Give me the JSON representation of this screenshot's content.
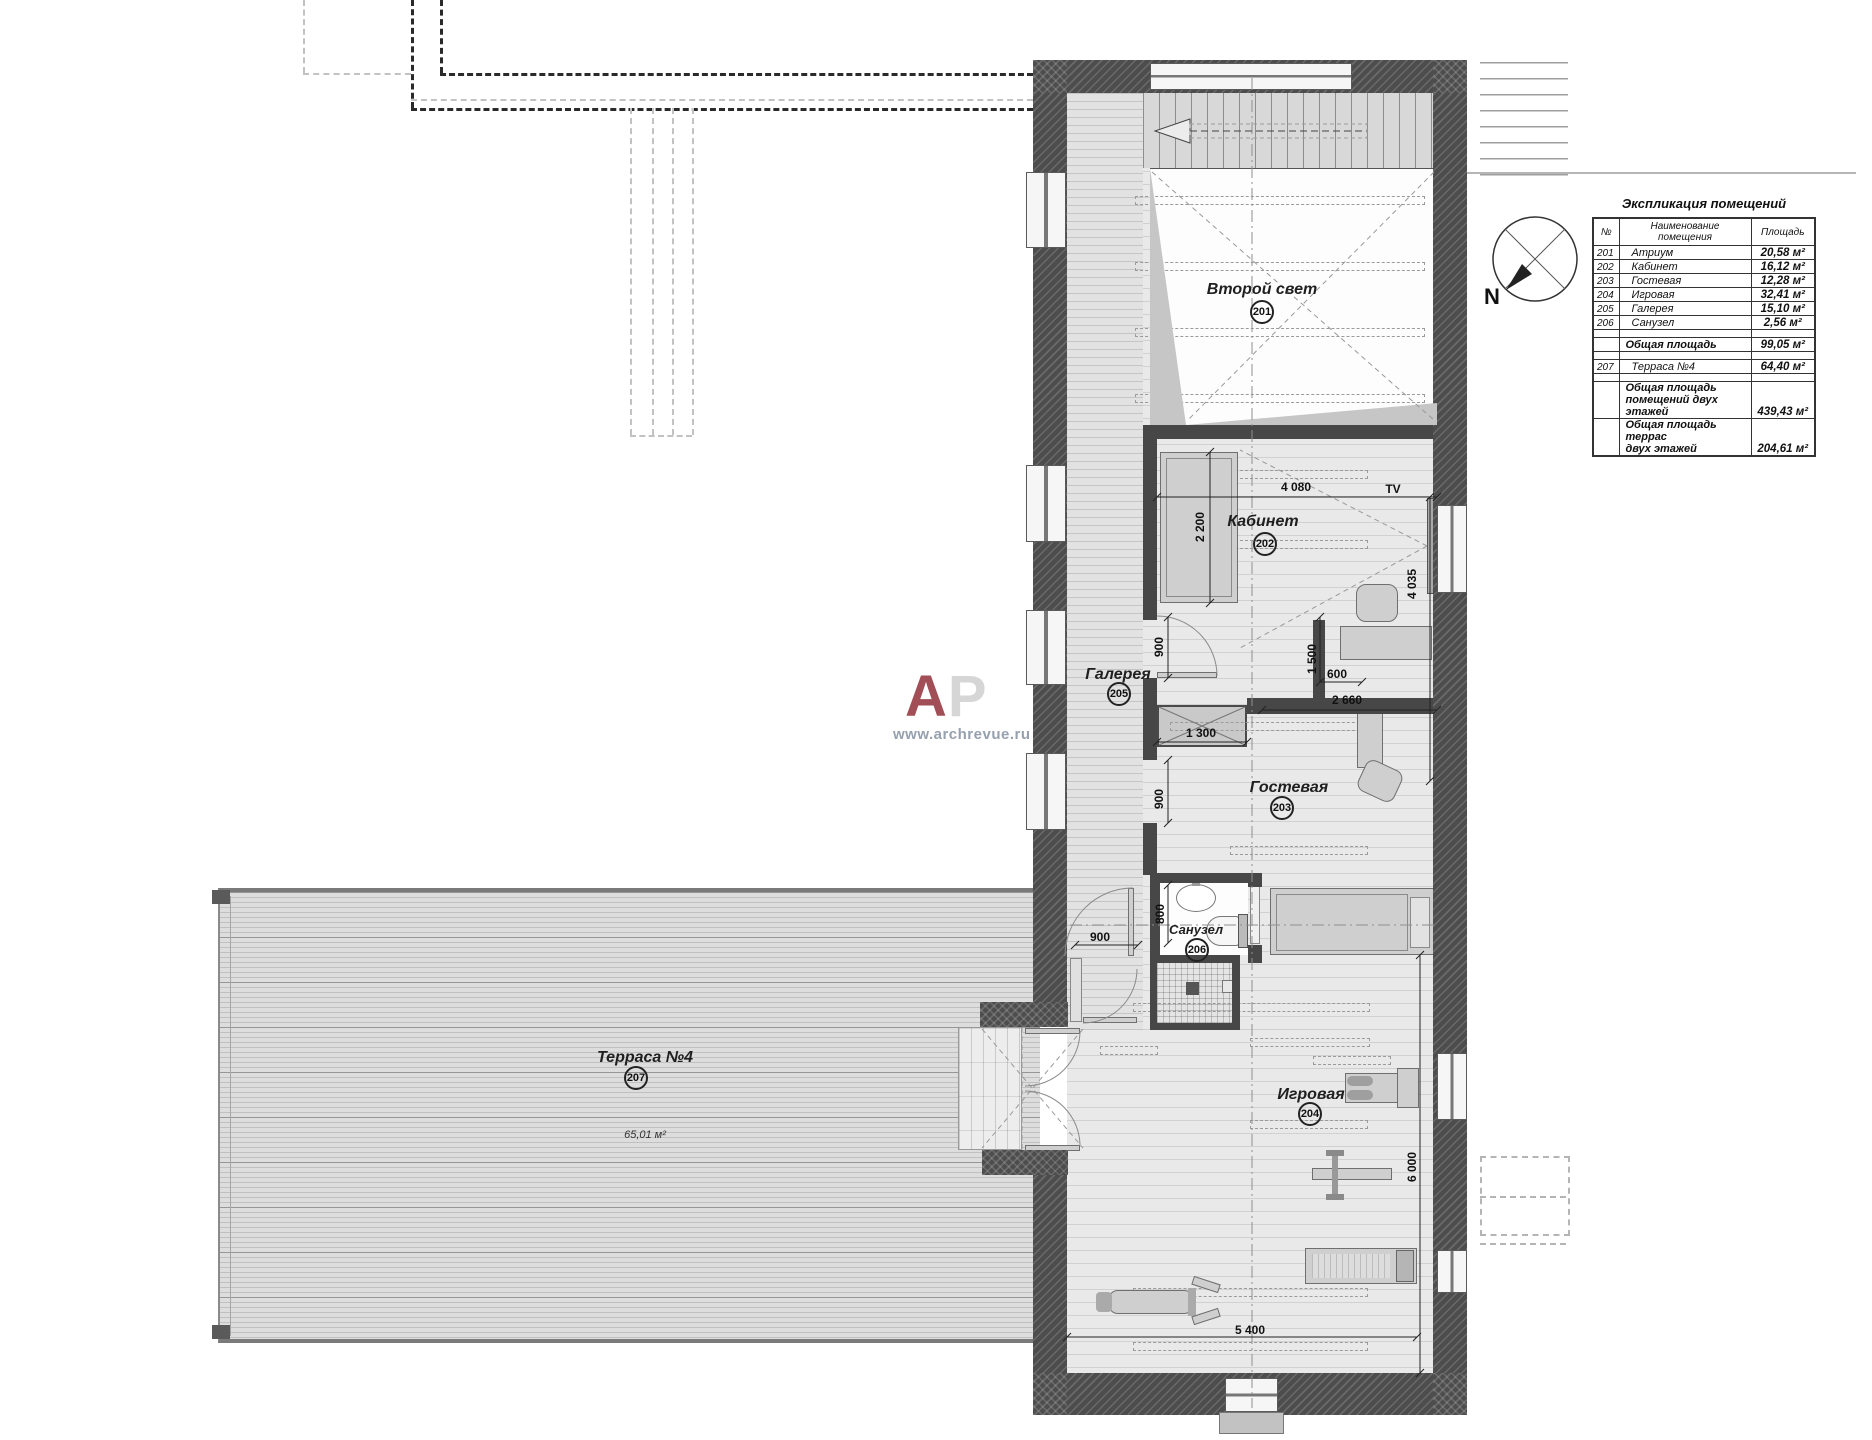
{
  "legend": {
    "title": "Экспликация помещений",
    "col_num": "№",
    "col_name": "Наименование помещения",
    "col_area": "Площадь",
    "rows": [
      {
        "num": "201",
        "name": "Атриум",
        "area": "20,58 м²"
      },
      {
        "num": "202",
        "name": "Кабинет",
        "area": "16,12 м²"
      },
      {
        "num": "203",
        "name": "Гостевая",
        "area": "12,28 м²"
      },
      {
        "num": "204",
        "name": "Игровая",
        "area": "32,41 м²"
      },
      {
        "num": "205",
        "name": "Галерея",
        "area": "15,10 м²"
      },
      {
        "num": "206",
        "name": "Санузел",
        "area": "2,56 м²"
      },
      {
        "blank": true
      },
      {
        "name": "Общая площадь",
        "area": "99,05 м²",
        "total": true
      },
      {
        "blank": true
      },
      {
        "num": "207",
        "name": "Терраса №4",
        "area": "64,40 м²"
      },
      {
        "blank": true
      },
      {
        "name": "Общая площадь",
        "name2": "помещений двух этажей",
        "area": "439,43 м²",
        "total": true
      },
      {
        "name": "Общая площадь террас",
        "name2": "двух этажей",
        "area": "204,61 м²",
        "total": true
      }
    ]
  },
  "plan": {
    "rooms": [
      {
        "name": "Второй свет",
        "number": "201"
      },
      {
        "name": "Кабинет",
        "number": "202"
      },
      {
        "name": "Гостевая",
        "number": "203"
      },
      {
        "name": "Игровая",
        "number": "204"
      },
      {
        "name": "Галерея",
        "number": "205"
      },
      {
        "name": "Санузел",
        "number": "206"
      },
      {
        "name": "Терраса №4",
        "number": "207",
        "area": "65,01 м²"
      }
    ],
    "labels": {
      "tv": "TV",
      "north": "N"
    }
  },
  "dims": [
    "4 080",
    "2 200",
    "4 035",
    "900",
    "1 500",
    "600",
    "2 660",
    "1 300",
    "900",
    "800",
    "900",
    "6 000",
    "5 400"
  ],
  "watermark": {
    "a": "А",
    "p": "Р",
    "site": "www.archrevue.ru"
  },
  "colors": {
    "watermark_a": "#a14e56",
    "watermark_p": "#d6d6d6",
    "wall": "#4d4d4d"
  }
}
